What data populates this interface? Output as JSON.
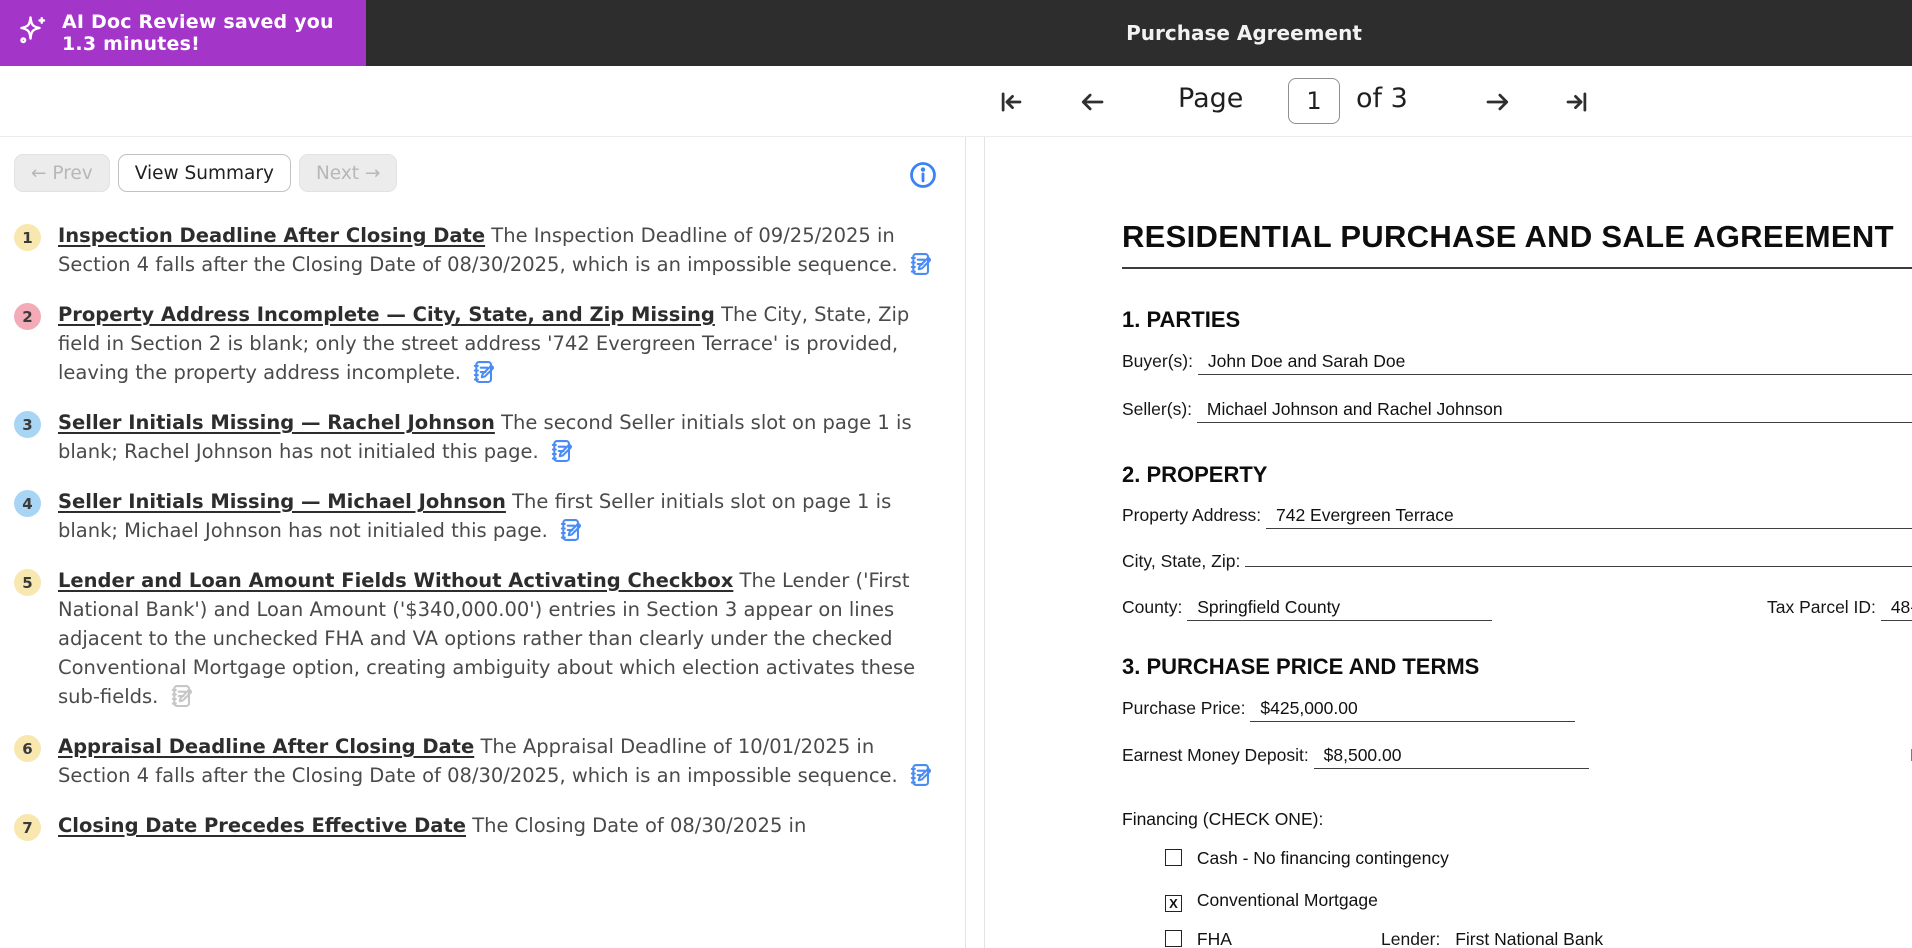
{
  "banner": {
    "badge_text": "AI Doc Review saved you 1.3 minutes!",
    "title": "Purchase Agreement",
    "badge_color": "#a435c9",
    "bar_color": "#2d2d2d"
  },
  "pager": {
    "label": "Page",
    "current": "1",
    "of_label": "of",
    "total": "3"
  },
  "review_panel": {
    "prev_label": "← Prev",
    "summary_label": "View Summary",
    "next_label": "Next →",
    "accent_blue": "#4a8bf5",
    "items": [
      {
        "num": "1",
        "badge_style": "background:#f8e7af",
        "title": "Inspection Deadline After Closing Date",
        "body": "The Inspection Deadline of 09/25/2025 in Section 4 falls after the Closing Date of 08/30/2025, which is an impossible sequence.",
        "icon_style": "color:#4a8bf5"
      },
      {
        "num": "2",
        "badge_style": "background:#f3abb8",
        "title": "Property Address Incomplete — City, State, and Zip Missing",
        "body": "The City, State, Zip field in Section 2 is blank; only the street address '742 Evergreen Terrace' is provided, leaving the property address incomplete.",
        "icon_style": "color:#4a8bf5"
      },
      {
        "num": "3",
        "badge_style": "background:#a9d5f4",
        "title": "Seller Initials Missing — Rachel Johnson",
        "body": "The second Seller initials slot on page 1 is blank; Rachel Johnson has not initialed this page.",
        "icon_style": "color:#4a8bf5"
      },
      {
        "num": "4",
        "badge_style": "background:#a9d5f4",
        "title": "Seller Initials Missing — Michael Johnson",
        "body": "The first Seller initials slot on page 1 is blank; Michael Johnson has not initialed this page.",
        "icon_style": "color:#4a8bf5"
      },
      {
        "num": "5",
        "badge_style": "background:#f8e7af",
        "title": "Lender and Loan Amount Fields Without Activating Checkbox",
        "body": "The Lender ('First National Bank') and Loan Amount ('$340,000.00') entries in Section 3 appear on lines adjacent to the unchecked FHA and VA options rather than clearly under the checked Conventional Mortgage option, creating ambiguity about which election activates these sub-fields.",
        "icon_style": "color:#c6c6c6"
      },
      {
        "num": "6",
        "badge_style": "background:#f8e7af",
        "title": "Appraisal Deadline After Closing Date",
        "body": "The Appraisal Deadline of 10/01/2025 in Section 4 falls after the Closing Date of 08/30/2025, which is an impossible sequence.",
        "icon_style": "color:#4a8bf5"
      },
      {
        "num": "7",
        "badge_style": "background:#f8e7af",
        "title": "Closing Date Precedes Effective Date",
        "body": "The Closing Date of 08/30/2025 in",
        "icon_style": "color:#4a8bf5"
      }
    ]
  },
  "document": {
    "title": "RESIDENTIAL PURCHASE AND SALE AGREEMENT",
    "parties_head": "1. PARTIES",
    "buyer_label": "Buyer(s):",
    "buyer_value": "John Doe and Sarah Doe",
    "seller_label": "Seller(s):",
    "seller_value": "Michael Johnson and Rachel Johnson",
    "property_head": "2. PROPERTY",
    "address_label": "Property Address:",
    "address_value": "742 Evergreen Terrace",
    "city_label": "City, State, Zip:",
    "city_value": "",
    "county_label": "County:",
    "county_value": "Springfield County",
    "parcel_label": "Tax Parcel ID:",
    "parcel_value": "48-291-0034",
    "price_head": "3. PURCHASE PRICE AND TERMS",
    "price_label": "Purchase Price:",
    "price_value": "$425,000.00",
    "earnest_label": "Earnest Money Deposit:",
    "earnest_value": "$8,500.00",
    "dueby_label": "Due by:",
    "dueby_value": "09",
    "financing_label": "Financing (CHECK ONE):",
    "options": [
      {
        "mark": "",
        "label": "Cash - No financing contingency"
      },
      {
        "mark": "X",
        "label": "Conventional Mortgage"
      },
      {
        "mark": "",
        "label": "FHA"
      }
    ],
    "lender_label": "Lender:",
    "lender_value": "First National Bank"
  }
}
